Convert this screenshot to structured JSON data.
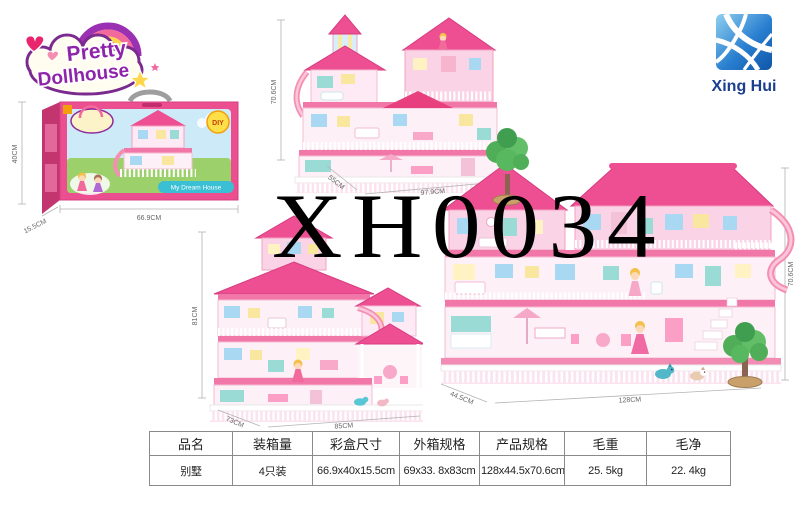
{
  "brand": {
    "logo_line1": "Pretty",
    "logo_line2": "Dollhouse",
    "company_name": "Xing Hui",
    "accent_pink": "#ee4f92",
    "accent_blue": "#1b3f8f"
  },
  "watermark": "XH0034",
  "views": {
    "box": {
      "height_label": "40CM",
      "width_label": "66.9CM",
      "depth_label": "15.5CM",
      "diy_badge": "DIY",
      "tagline": "My Dream House"
    },
    "house_top": {
      "height_label": "70.6CM",
      "depth_label": "55CM",
      "width_label": "97.9CM"
    },
    "house_left": {
      "height_label": "81CM",
      "depth_label": "73CM",
      "width_label": "85CM"
    },
    "house_right": {
      "height_label": "70.6CM",
      "depth_label": "44.5CM",
      "width_label": "128CM"
    }
  },
  "table": {
    "headers": [
      "品名",
      "装箱量",
      "彩盒尺寸",
      "外箱规格",
      "产品规格",
      "毛重",
      "毛净"
    ],
    "rows": [
      [
        "别墅",
        "4只装",
        "66.9x40x15.5cm",
        "69x33. 8x83cm",
        "128x44.5x70.6cm",
        "25. 5kg",
        "22. 4kg"
      ]
    ]
  }
}
